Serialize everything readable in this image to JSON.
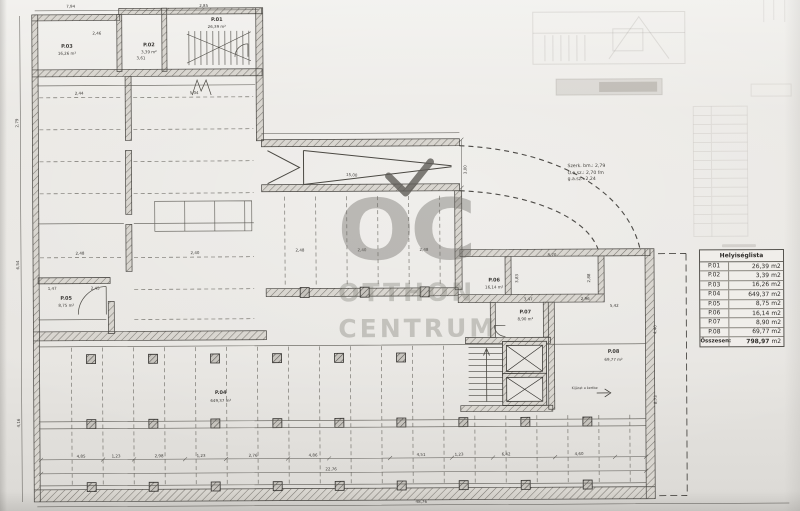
{
  "watermark": {
    "top": "OC",
    "middle": "OTTHON",
    "bottom": "CENTRUM"
  },
  "notes": {
    "line1": "Szerk. bm.: 2,79",
    "line2": "O.a.sz.: 2,70 fm",
    "line3": "g.a.sz.: 2,24"
  },
  "area_table": {
    "title": "Helyiséglista",
    "unit": "m2",
    "rows": [
      {
        "id": "P.01",
        "area": "26,39"
      },
      {
        "id": "P.02",
        "area": "3,39"
      },
      {
        "id": "P.03",
        "area": "16,26"
      },
      {
        "id": "P.04",
        "area": "649,37"
      },
      {
        "id": "P.05",
        "area": "8,75"
      },
      {
        "id": "P.06",
        "area": "16,14"
      },
      {
        "id": "P.07",
        "area": "8,90"
      },
      {
        "id": "P.08",
        "area": "69,77"
      }
    ],
    "total": {
      "label": "Összesen:",
      "area": "798,97"
    }
  },
  "rooms": {
    "p01": {
      "id": "P.01",
      "area": "26,39 m²"
    },
    "p02": {
      "id": "P.02",
      "area": "3,39 m²"
    },
    "p03": {
      "id": "P.03",
      "area": "16,26 m²"
    },
    "p04": {
      "id": "P.04",
      "area": "649,37 m²"
    },
    "p05": {
      "id": "P.05",
      "area": "8,75 m²"
    },
    "p06": {
      "id": "P.06",
      "area": "16,14 m²"
    },
    "p07": {
      "id": "P.07",
      "area": "8,90 m²"
    },
    "p08": {
      "id": "P.08",
      "area": "69,77 m²"
    }
  },
  "plan": {
    "exit_note": "Kijárat a kertbe"
  },
  "dims": [
    "7,94",
    "2,85",
    "2,46",
    "3,61",
    "2,44",
    "5,04",
    "2,48",
    "2,40",
    "1,47",
    "2,45",
    "2,48",
    "2,40",
    "2,48",
    "8,70",
    "3,83",
    "2,88",
    "3,47",
    "2,96",
    "5,42",
    "4,40",
    "8,73",
    "4,85",
    "1,23",
    "2,98",
    "1,23",
    "2,76",
    "4,86",
    "22,76",
    "4,51",
    "1,23",
    "6,42",
    "4,60",
    "48,76",
    "2,79",
    "6,54",
    "4,16",
    "3,00",
    "15,00"
  ]
}
